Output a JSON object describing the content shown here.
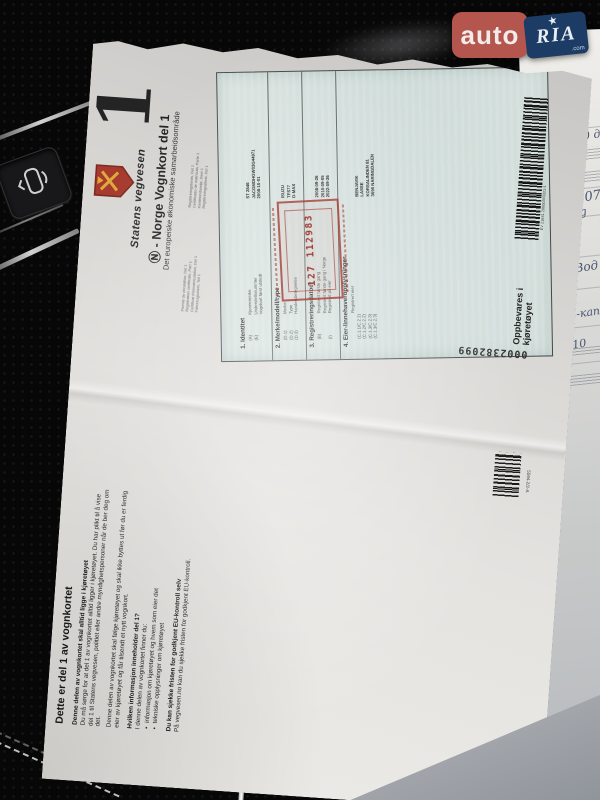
{
  "watermark": {
    "auto": "auto",
    "ria": "RIA",
    "tld": ".com"
  },
  "background": {
    "handwriting": [
      "д /40 дв",
      "95076",
      "лg",
      "Вод",
      "3",
      "-кап.",
      "/ 10"
    ]
  },
  "document": {
    "part_number": "1",
    "agency": "Statens vegvesen",
    "title": "Ⓝ - Norge Vognkort del 1",
    "subtitle": "Det europeiske økonomiske samarbeidsområde",
    "multilingual": [
      "Permis de circulation, Del 1",
      "Registration certificate, Part 1",
      "Certificat d'immatriculation, Del 1",
      "Fahrzeugschein, Teil 1",
      "Registreringsbevis, Del 1",
      "Certificado de matrícula, Parte 1",
      "Kentekenbewijs, Deel 1",
      "Registreringsattest, Del 1"
    ],
    "info": {
      "heading": "Dette er del 1 av vognkortet",
      "p1_bold": "Denne delen av vognkortet skal alltid ligge i kjøretøyet",
      "p1": "Du må sørge for at del 1 av vognkortet alltid ligger i kjøretøyet. Du har plikt til å vise del 1 til Statens vegvesen, politiet eller andre myndighetspersoner når de ber deg om det.",
      "p2": "Denne delen av vognkortet skal følge kjøretøyet og skal ikke byttes ut før du er ferdig eier av kjøretøyet og får tilsendt et nytt vognkort.",
      "p3_bold": "Hvilken informasjon inneholder del 1?",
      "p3": "I denne delen av vognkortet finner du:",
      "bullet1": "informasjon om kjøretøyet og hvem som eier det",
      "bullet2": "tekniske opplysninger om kjøretøyet",
      "p4_bold": "Du kan sjekke fristen for godkjent EU-kontroll selv",
      "p4": "På vegvesen.no kan du sjekke fristen for godkjent EU-kontroll."
    },
    "form": {
      "s1": {
        "header": "1. Identitet",
        "f1_code": "(A)",
        "f1_label": "Kjennemerke",
        "f1_value": "ST 2846",
        "f2_code": "(E)",
        "f2_label": "Understellsnummer",
        "f2_value": "JACGMDHGW03G44971",
        "f3_code": "",
        "f3_label": "Vognkort først utstedt",
        "f3_value": "2008-10-01"
      },
      "s2": {
        "header": "2. Merke/modell/type",
        "f1_code": "(D.1)",
        "f1_label": "Merke",
        "f1_value": "ISUZU",
        "f2_code": "(D.2)",
        "f2_label": "Type",
        "f2_value": "TFS77",
        "f3_code": "(D.3)",
        "f3_label": "Handelsbetegnelse",
        "f3_value": "D-MAX"
      },
      "s3": {
        "header": "3. Registreringsdatoer",
        "f1_code": "(B)",
        "f1_label": "Registrert første gang",
        "f1_value": "2008-09-26",
        "f2_code": "",
        "f2_label": "Registrert første gang i Norge",
        "f2_value": "2010-09-05",
        "f3_code": "(I)",
        "f3_label": "Registrert på eier",
        "f3_value": "2022-09-26"
      },
      "s4": {
        "header": "4. Eier-/innehaveropplysninger",
        "sub": "Registrert eier",
        "f1_code": "(C.1.1/C.2.1)",
        "f1_value": "BENJAVIK",
        "f2_code": "(C.1.2/C.2.2)",
        "f2_value": "LASSE",
        "f3_code": "(C.1.3/C.2.3)",
        "f3_value": "KORSALINDEN 81",
        "f4_code": "(C.1.3/C.2.3)",
        "f4_value": "3090 NARINGDALEN"
      }
    },
    "stamp_number": "127 112983",
    "barcode1_label": "EV 21841 20000393321-1",
    "serial": "0002382099",
    "keep_note_line1": "Oppbevares i",
    "keep_note_line2": "kjøretøyet",
    "form_code": "5594-2/2-A"
  },
  "colors": {
    "badge_red": "#b4564e",
    "badge_navy": "#1c3c66",
    "stamp_red": "#a8423a",
    "form_blue": "#d6e1de",
    "paper": "#e8e6e2"
  }
}
